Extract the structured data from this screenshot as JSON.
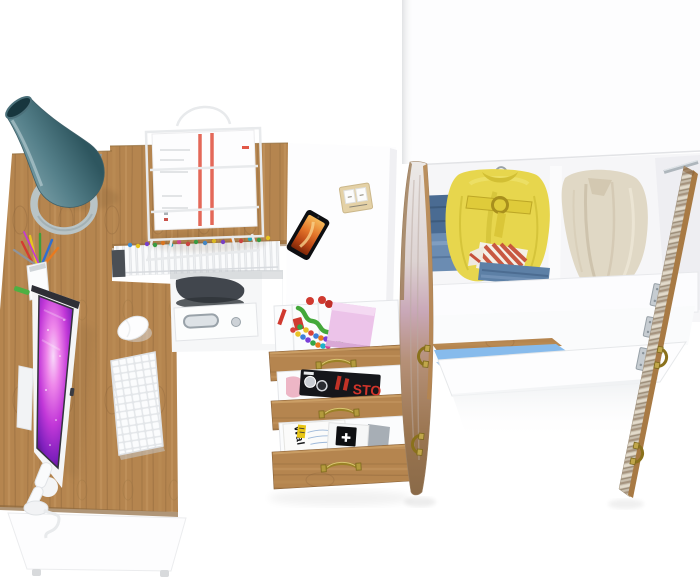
{
  "canvas": {
    "width": 700,
    "height": 581,
    "background": "#ffffff"
  },
  "scene": {
    "kind": "3d-furniture-render-top-view",
    "description": "Bird's-eye render of a corner study set: oak L-desk with teal cone lamp, monitor, keyboard and mouse; wire document tray and notebook row on the hutch; white cabinet top with smartphone and flip calendar over three open oak drawers holding magazines and stationery; open two-door oak wardrobe with folded jeans, a belted yellow jacket, striped shirts and a beige coat.",
    "colors": {
      "wood_base": "#b5854f",
      "wood_grain": "#8a6238",
      "white_panel": "#fdfdfe",
      "panel_edge": "#e4e6e9",
      "lamp_teal": "#55808a",
      "lamp_teal_dark": "#2e565f",
      "screen_magenta": "#c238d8",
      "screen_violet": "#35094f",
      "jeans_blue": "#4a6b92",
      "jeans_light": "#6b8cb2",
      "jacket_yellow": "#e7d64d",
      "coat_beige": "#e0d8c5",
      "stripe_red": "#c6503a",
      "sticky_pink": "#ecc3e9",
      "brass": "#9a8226",
      "chrome": "#b9c0c6",
      "bed_blue": "#87bbec",
      "door_pink": "#c9a8b8",
      "magazine_black": "#15161a",
      "magazine_red": "#d1342a",
      "flame_orange": "#e4762a"
    },
    "objects": [
      "desk",
      "desk-hutch",
      "desk-lamp",
      "pencil-cup",
      "colored-pencils",
      "monitor",
      "monitor-stand",
      "keyboard",
      "mouse",
      "document-tray",
      "paper-stack",
      "notebook-row",
      "pc-unit",
      "utility-drawer",
      "cabinet-top",
      "smartphone",
      "flip-calendar",
      "drawer-top",
      "drawer-middle",
      "drawer-bottom",
      "sticky-notes",
      "bead-necklace",
      "green-cord",
      "black-magazine",
      "white-magazine",
      "booklet",
      "wardrobe-top",
      "folded-jeans-stack",
      "yellow-jacket",
      "striped-shirts",
      "folded-jeans",
      "beige-coat",
      "hanger-rod",
      "wardrobe-left-door",
      "wardrobe-right-door",
      "door-handles",
      "door-hinges",
      "blue-accent-rail"
    ]
  },
  "texts": {
    "white_magazine_spine": "Wal",
    "black_magazine_title_fragment": "STO",
    "booklet_symbol": "✚"
  }
}
